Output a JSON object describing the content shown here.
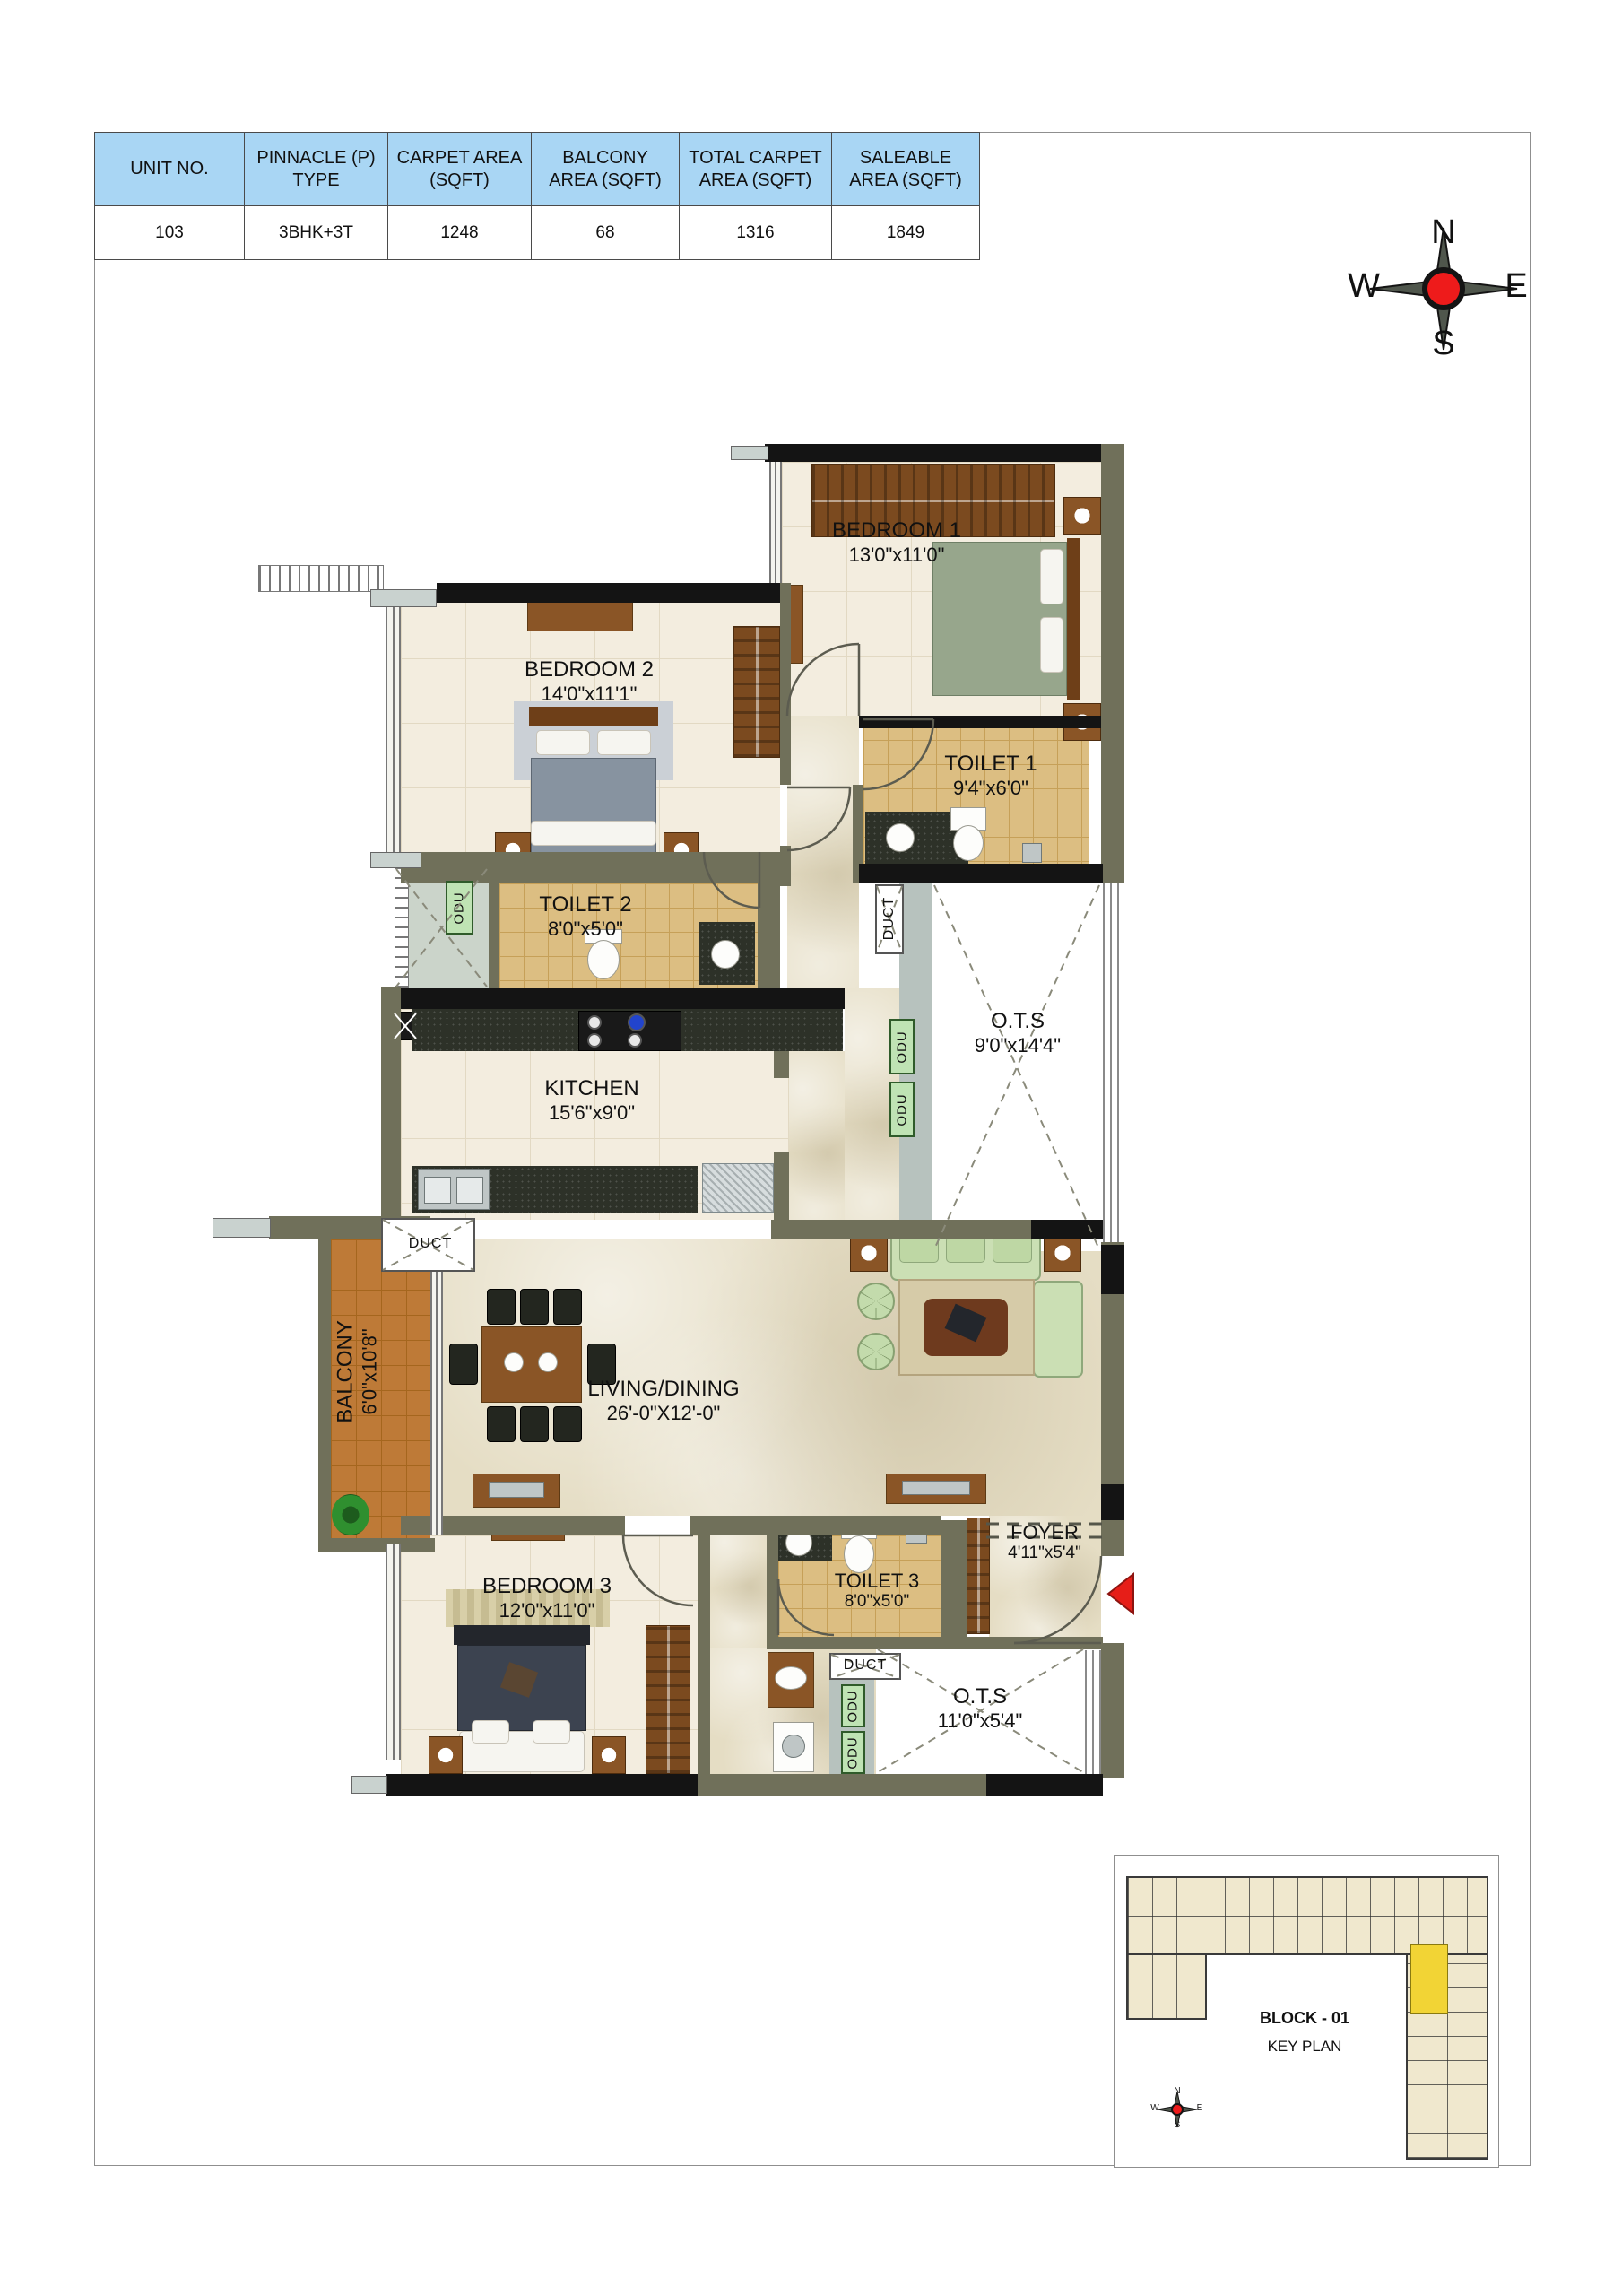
{
  "table": {
    "headers": [
      "UNIT NO.",
      "PINNACLE (P) TYPE",
      "CARPET AREA (SQFT)",
      "BALCONY AREA (SQFT)",
      "TOTAL CARPET AREA (SQFT)",
      "SALEABLE AREA (SQFT)"
    ],
    "values": [
      "103",
      "3BHK+3T",
      "1248",
      "68",
      "1316",
      "1849"
    ]
  },
  "compass": {
    "north": "N",
    "south": "S",
    "east": "E",
    "west": "W"
  },
  "rooms": {
    "bedroom1": {
      "name": "BEDROOM 1",
      "dims": "13'0\"x11'0\""
    },
    "bedroom2": {
      "name": "BEDROOM 2",
      "dims": "14'0\"x11'1\""
    },
    "bedroom3": {
      "name": "BEDROOM 3",
      "dims": "12'0\"x11'0\""
    },
    "toilet1": {
      "name": "TOILET 1",
      "dims": "9'4\"x6'0\""
    },
    "toilet2": {
      "name": "TOILET 2",
      "dims": "8'0\"x5'0\""
    },
    "toilet3": {
      "name": "TOILET 3",
      "dims": "8'0\"x5'0\""
    },
    "kitchen": {
      "name": "KITCHEN",
      "dims": "15'6\"x9'0\""
    },
    "ots_upper": {
      "name": "O.T.S",
      "dims": "9'0\"x14'4\""
    },
    "ots_lower": {
      "name": "O.T.S",
      "dims": "11'0\"x5'4\""
    },
    "living": {
      "name": "LIVING/DINING",
      "dims": "26'-0\"X12'-0\""
    },
    "balcony": {
      "name": "BALCONY",
      "dims": "6'0\"x10'8\""
    },
    "foyer": {
      "name": "FOYER",
      "dims": "4'11\"x5'4\""
    }
  },
  "service": {
    "duct": "DUCT",
    "odu": "ODU"
  },
  "keyplan": {
    "block": "BLOCK - 01",
    "title": "KEY PLAN",
    "compass": {
      "north": "N",
      "south": "S",
      "east": "E",
      "west": "W"
    }
  },
  "colors": {
    "header_blue": "#A9D6F4",
    "wall_olive": "#70705A",
    "wall_black": "#141414",
    "floor_cream": "#F3EDDF",
    "floor_tan": "#DCBE82",
    "balcony_orange": "#BE7A37",
    "highlight_yellow": "#F2D435",
    "entry_arrow_red": "#E61E18"
  }
}
